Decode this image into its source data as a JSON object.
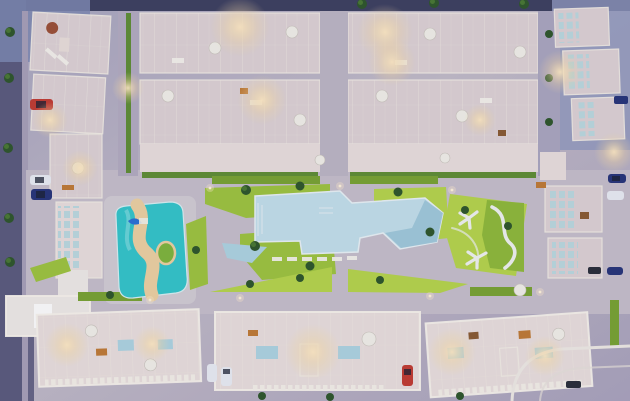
{
  "scene": {
    "type": "aerial-3d-render",
    "description": "Top-down dusk aerial 3D render of a residential apartment complex: perimeter rows of white rooftop-terrace apartments around a central landscaped courtyard with a large pale-blue lagoon pool, a turquoise lazy-river pool with sand path and island, lawns, trees and warm rooftop lighting",
    "time_of_day": "dusk"
  },
  "palette": {
    "ground": "#b7afc2",
    "ground_cool": "#9198bd",
    "ground_corner": "#7e88b0",
    "road_dark": "#3d3f5e",
    "road_side": "#5b5a7c",
    "deck": "#c6bec9",
    "deck_light": "#d2cbd2",
    "building": "#ddd1d3",
    "building_light": "#e9dedb",
    "building_white": "#efe9e5",
    "roof_inner": "#cfc3c9",
    "grass": "#9ec33d",
    "grass_light": "#b6d44a",
    "grass_dark": "#79a230",
    "hedge": "#5f8d32",
    "tree": "#2e5629",
    "pool_main": "#c3dfe9",
    "pool_main_deep": "#97c2d5",
    "pool_kids": "#aed3e0",
    "pool_river": "#34c4c8",
    "pool_river_light": "#7fdcdd",
    "sand": "#ecd0a0",
    "island": "#7fb43a",
    "slide_blue": "#2a6fd4",
    "glow_warm": "#ffe8c0",
    "car_red": "#c23b30",
    "car_blue": "#273478",
    "car_white": "#e9ebf2",
    "car_black": "#2a2d38",
    "umbrella": "#f2efe7",
    "path_white": "#f0f1ee"
  },
  "inventory": {
    "pools": [
      {
        "name": "main-lagoon-pool",
        "shape": "angular lagoon",
        "color_key": "pool_main"
      },
      {
        "name": "lazy-river-pool",
        "shape": "rounded with sand s-curve and island",
        "color_key": "pool_river"
      },
      {
        "name": "kids-triangle-pool",
        "shape": "small triangle",
        "color_key": "pool_kids"
      }
    ],
    "building_blocks": {
      "top_row_house_groups": 4,
      "left_column_blocks": 3,
      "right_edge_blocks": 5,
      "bottom_row_blocks": 3,
      "corner_white_building": 1
    },
    "cars": [
      {
        "color": "red",
        "location": "left street"
      },
      {
        "color": "white",
        "location": "left street"
      },
      {
        "color": "dark-blue",
        "location": "left street"
      },
      {
        "color": "white",
        "location": "bottom street"
      },
      {
        "color": "white-van",
        "location": "bottom street"
      },
      {
        "color": "red",
        "location": "bottom street"
      },
      {
        "color": "black",
        "location": "bottom-right street"
      },
      {
        "color": "dark-blue",
        "location": "right street"
      },
      {
        "color": "white-van",
        "location": "right street"
      },
      {
        "color": "blue",
        "location": "right street"
      },
      {
        "color": "dark-truck",
        "location": "top-right corner"
      }
    ],
    "umbrella_count": 14,
    "rooftop_terrace_pools": 4,
    "street_lamp_glows": 12
  }
}
